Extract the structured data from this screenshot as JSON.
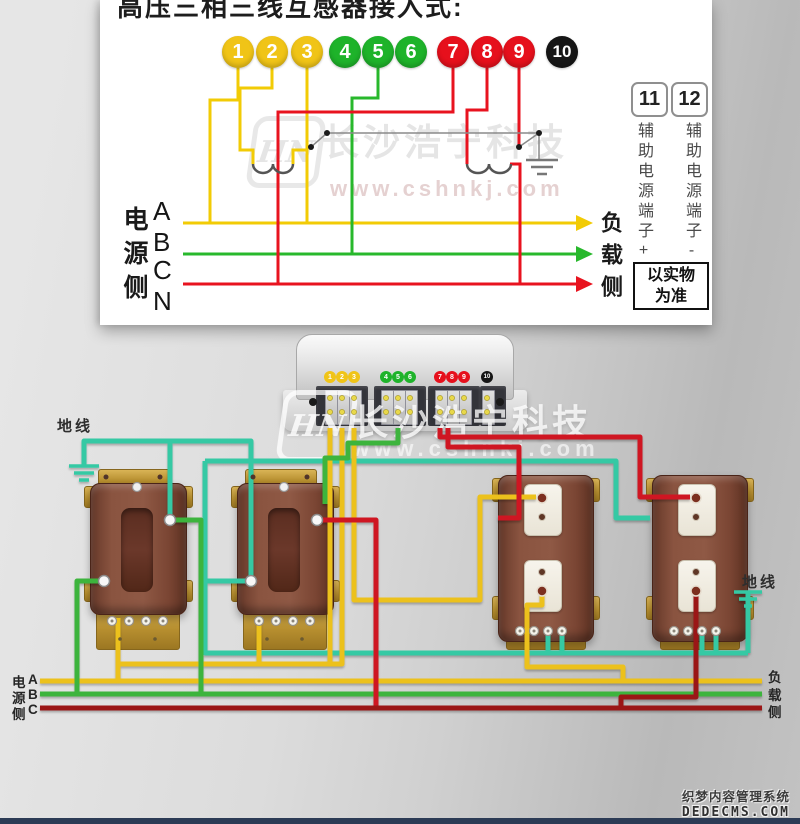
{
  "title": "高压三相三线互感器接入式:",
  "colors": {
    "circle_yellow": "#f0c417",
    "circle_green": "#1eb32a",
    "circle_red": "#e6101c",
    "circle_black": "#161616",
    "panel_yellow": "#f2cb05",
    "panel_green": "#28b82c",
    "panel_red": "#e8131f",
    "wire_yellow": "#ecc11b",
    "wire_green": "#3cb43c",
    "wire_teal": "#35c9a4",
    "wire_red": "#cf1620",
    "wire_darkred": "#9b1717",
    "screw_yellow": "#e8d84a"
  },
  "panel": {
    "circle_numbers": [
      "1",
      "2",
      "3",
      "4",
      "5",
      "6",
      "7",
      "8",
      "9",
      "10"
    ],
    "aux": {
      "t11": "11",
      "t12": "12",
      "label_plus": "辅助电源端子+",
      "label_minus": "辅助电源端子-",
      "note_line1": "以实物",
      "note_line2": "为准"
    },
    "source_side": "电源侧",
    "phases": [
      "A",
      "B",
      "C",
      "N"
    ],
    "load_side": "负载侧"
  },
  "meter": {
    "dots": [
      "1",
      "2",
      "3",
      "4",
      "5",
      "6",
      "7",
      "8",
      "9",
      "10"
    ],
    "terminal_xs": [
      330,
      342,
      354,
      386,
      398,
      410,
      440,
      452,
      464,
      487
    ],
    "terminal_ys": [
      398,
      412
    ]
  },
  "ground_label_left": "地线",
  "ground_label_right": "地线",
  "bottom": {
    "source_chars": [
      "电",
      "源",
      "侧"
    ],
    "source_phases": [
      "A",
      "B",
      "C"
    ],
    "load_chars": [
      "负",
      "载",
      "侧"
    ]
  },
  "watermark": {
    "logo": "HN",
    "brand": "长沙浩宁科技",
    "url": "www.cshnkj.com"
  },
  "footer_watermark": {
    "line1": "织梦内容管理系统",
    "line2": "DEDECMS.COM"
  }
}
